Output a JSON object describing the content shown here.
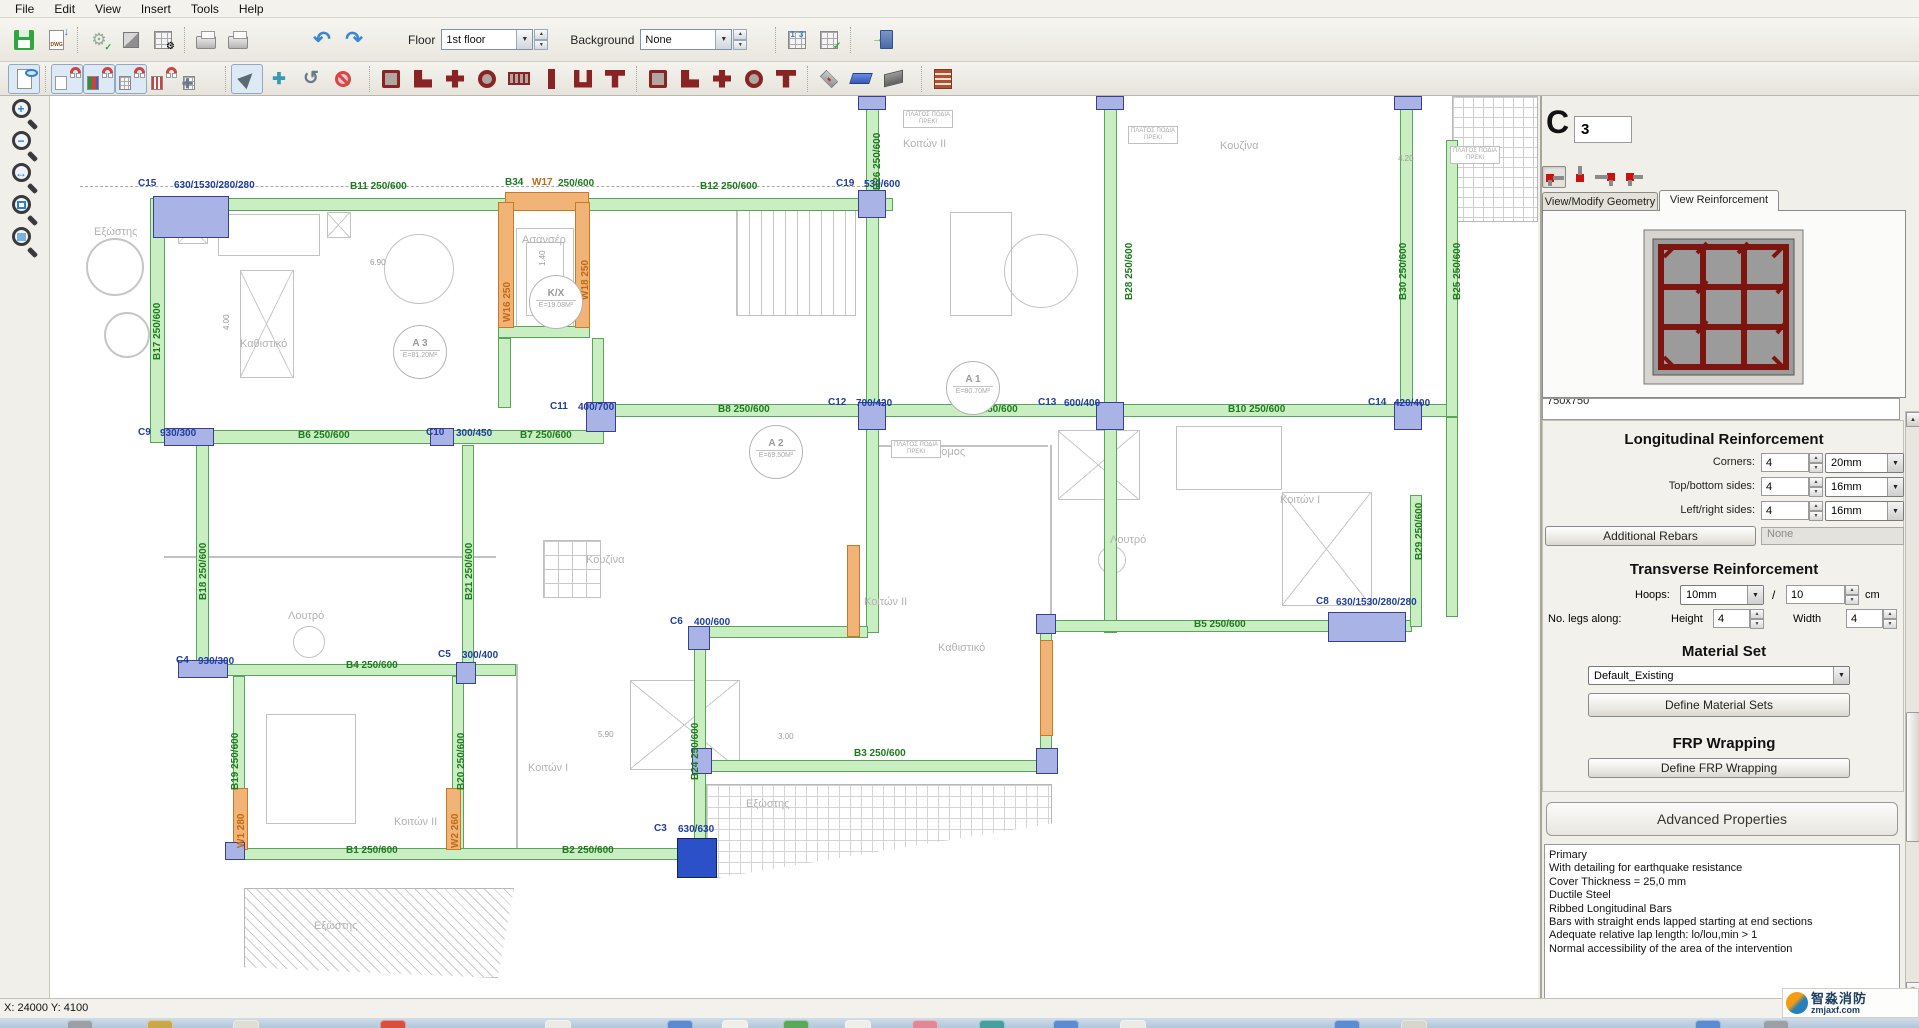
{
  "menu": {
    "items": [
      "File",
      "Edit",
      "View",
      "Insert",
      "Tools",
      "Help"
    ]
  },
  "toolbar": {
    "floor_label": "Floor",
    "floor_value": "1st floor",
    "background_label": "Background",
    "background_value": "None"
  },
  "panel": {
    "member_type": "C",
    "member_number": "3",
    "tabs": [
      {
        "label": "View/Modify Geometry",
        "active": false
      },
      {
        "label": "View Reinforcement",
        "active": true
      }
    ],
    "section_size": "750x750",
    "longitudinal": {
      "title": "Longitudinal Reinforcement",
      "rows": [
        {
          "label": "Corners:",
          "count": "4",
          "diameter": "20mm"
        },
        {
          "label": "Top/bottom sides:",
          "count": "4",
          "diameter": "16mm"
        },
        {
          "label": "Left/right sides:",
          "count": "4",
          "diameter": "16mm"
        }
      ],
      "additional_rebars_button": "Additional Rebars",
      "additional_rebars_value": "None"
    },
    "transverse": {
      "title": "Transverse Reinforcement",
      "hoops_label": "Hoops:",
      "hoops_diameter": "10mm",
      "separator": "/",
      "spacing": "10",
      "spacing_unit": "cm",
      "legs_label": "No. legs along:",
      "height_label": "Height",
      "height_value": "4",
      "width_label": "Width",
      "width_value": "4"
    },
    "material": {
      "title": "Material Set",
      "selected": "Default_Existing",
      "button": "Define Material Sets"
    },
    "frp": {
      "title": "FRP Wrapping",
      "button": "Define FRP Wrapping"
    },
    "advanced": {
      "title": "Advanced Properties",
      "lines": [
        "Primary",
        "With detailing for earthquake resistance",
        "Cover Thickness = 25,0 mm",
        "Ductile Steel",
        "Ribbed Longitudinal Bars",
        "Bars with straight ends lapped starting at end sections",
        "Adequate relative lap length: lo/lou,min > 1",
        "Normal accessibility of the area of the intervention"
      ]
    },
    "colors": {
      "rebar": "#7c150f",
      "concrete": "#9b9b9b",
      "selected_column": "#2b50c8"
    }
  },
  "status_bar": {
    "coords": "X: 24000  Y: 4100"
  },
  "watermark": {
    "line1": "智淼消防",
    "line2": "zmjaxf.com"
  },
  "plan": {
    "box_label": [
      "ΠΛΑΤΟΣ ΠΟΔΙΑ",
      "ΠΡΕΚΙ"
    ],
    "beams": [
      [
        153,
        198,
        740,
        13,
        "g"
      ],
      [
        150,
        198,
        15,
        245,
        "g"
      ],
      [
        164,
        430,
        440,
        14,
        "g"
      ],
      [
        196,
        443,
        13,
        222,
        "g"
      ],
      [
        592,
        404,
        862,
        13,
        "g"
      ],
      [
        866,
        96,
        13,
        315,
        "g"
      ],
      [
        1104,
        96,
        13,
        315,
        "g"
      ],
      [
        1400,
        96,
        13,
        315,
        "g"
      ],
      [
        1446,
        140,
        12,
        277,
        "g"
      ],
      [
        866,
        417,
        13,
        216,
        "g"
      ],
      [
        1104,
        417,
        13,
        216,
        "g"
      ],
      [
        1446,
        417,
        12,
        200,
        "g"
      ],
      [
        700,
        626,
        168,
        12,
        "g"
      ],
      [
        1050,
        620,
        362,
        12,
        "g"
      ],
      [
        1410,
        495,
        12,
        132,
        "g"
      ],
      [
        700,
        760,
        352,
        12,
        "g"
      ],
      [
        694,
        632,
        12,
        216,
        "g"
      ],
      [
        1040,
        632,
        12,
        140,
        "g"
      ],
      [
        196,
        664,
        320,
        12,
        "g"
      ],
      [
        233,
        676,
        12,
        180,
        "g"
      ],
      [
        452,
        676,
        12,
        180,
        "g"
      ],
      [
        462,
        445,
        12,
        225,
        "g"
      ],
      [
        233,
        848,
        477,
        12,
        "g"
      ],
      [
        498,
        326,
        92,
        12,
        "g"
      ],
      [
        498,
        338,
        13,
        70,
        "g"
      ],
      [
        592,
        338,
        12,
        66,
        "g"
      ],
      [
        505,
        192,
        84,
        19,
        "o"
      ],
      [
        498,
        202,
        16,
        126,
        "o"
      ],
      [
        575,
        202,
        15,
        126,
        "o"
      ],
      [
        233,
        788,
        15,
        62,
        "o"
      ],
      [
        446,
        788,
        15,
        62,
        "o"
      ],
      [
        1040,
        640,
        13,
        96,
        "o"
      ],
      [
        847,
        545,
        13,
        92,
        "o"
      ]
    ],
    "columns": [
      [
        153,
        196,
        76,
        42,
        0
      ],
      [
        858,
        190,
        28,
        28,
        0
      ],
      [
        586,
        402,
        30,
        30,
        0
      ],
      [
        858,
        402,
        28,
        28,
        0
      ],
      [
        1096,
        402,
        28,
        28,
        0
      ],
      [
        1394,
        402,
        28,
        28,
        0
      ],
      [
        164,
        428,
        50,
        18,
        0
      ],
      [
        430,
        428,
        24,
        18,
        0
      ],
      [
        178,
        660,
        50,
        18,
        0
      ],
      [
        456,
        662,
        20,
        22,
        0
      ],
      [
        688,
        626,
        22,
        24,
        0
      ],
      [
        1328,
        612,
        78,
        30,
        0
      ],
      [
        692,
        748,
        20,
        26,
        0
      ],
      [
        1036,
        748,
        22,
        26,
        0
      ],
      [
        1036,
        614,
        20,
        20,
        0
      ],
      [
        225,
        842,
        20,
        18,
        0
      ],
      [
        858,
        96,
        28,
        14,
        0
      ],
      [
        1096,
        96,
        28,
        14,
        0
      ],
      [
        1394,
        96,
        28,
        14,
        0
      ],
      [
        677,
        838,
        40,
        40,
        1
      ]
    ],
    "labels": [
      [
        138,
        178,
        "C15",
        "b",
        0
      ],
      [
        174,
        180,
        "630/1530/280/280",
        "b",
        0
      ],
      [
        350,
        181,
        "B11  250/600",
        "g",
        0
      ],
      [
        505,
        177,
        "B34",
        "g",
        0
      ],
      [
        532,
        177,
        "W17",
        "o",
        0
      ],
      [
        558,
        178,
        "250/600",
        "g",
        0
      ],
      [
        700,
        181,
        "B12  250/600",
        "g",
        0
      ],
      [
        836,
        178,
        "C19",
        "b",
        0
      ],
      [
        864,
        179,
        "530/600",
        "b",
        0
      ],
      [
        872,
        190,
        "B26  250/600",
        "g",
        1
      ],
      [
        1124,
        300,
        "B28  250/600",
        "g",
        1
      ],
      [
        1398,
        300,
        "B30  250/600",
        "g",
        1
      ],
      [
        1452,
        300,
        "B25  250/600",
        "g",
        1
      ],
      [
        138,
        427,
        "C9",
        "b",
        0
      ],
      [
        160,
        428,
        "930/300",
        "b",
        0
      ],
      [
        298,
        430,
        "B6  250/600",
        "g",
        0
      ],
      [
        426,
        427,
        "C10",
        "b",
        0
      ],
      [
        456,
        428,
        "300/450",
        "b",
        0
      ],
      [
        520,
        430,
        "B7  250/600",
        "g",
        0
      ],
      [
        550,
        401,
        "C11",
        "b",
        0
      ],
      [
        578,
        402,
        "400/700",
        "b",
        0
      ],
      [
        718,
        404,
        "B8  250/600",
        "g",
        0
      ],
      [
        828,
        397,
        "C12",
        "b",
        0
      ],
      [
        856,
        398,
        "700/420",
        "b",
        0
      ],
      [
        966,
        404,
        "B9  250/600",
        "g",
        0
      ],
      [
        1038,
        397,
        "C13",
        "b",
        0
      ],
      [
        1064,
        398,
        "600/400",
        "b",
        0
      ],
      [
        1228,
        404,
        "B10  250/600",
        "g",
        0
      ],
      [
        1368,
        397,
        "C14",
        "b",
        0
      ],
      [
        1394,
        398,
        "420/400",
        "b",
        0
      ],
      [
        152,
        360,
        "B17  250/600",
        "g",
        1
      ],
      [
        198,
        600,
        "B18  250/600",
        "g",
        1
      ],
      [
        464,
        600,
        "B21  250/600",
        "g",
        1
      ],
      [
        1414,
        560,
        "B29  250/600",
        "g",
        1
      ],
      [
        1316,
        596,
        "C8",
        "b",
        0
      ],
      [
        1336,
        597,
        "630/1530/280/280",
        "b",
        0
      ],
      [
        1194,
        619,
        "B5  250/600",
        "g",
        0
      ],
      [
        670,
        616,
        "C6",
        "b",
        0
      ],
      [
        694,
        617,
        "400/600",
        "b",
        0
      ],
      [
        176,
        655,
        "C4",
        "b",
        0
      ],
      [
        198,
        656,
        "930/300",
        "b",
        0
      ],
      [
        346,
        660,
        "B4  250/600",
        "g",
        0
      ],
      [
        438,
        649,
        "C5",
        "b",
        0
      ],
      [
        462,
        650,
        "300/400",
        "b",
        0
      ],
      [
        230,
        790,
        "B19  250/600",
        "g",
        1
      ],
      [
        456,
        790,
        "B20  250/600",
        "g",
        1
      ],
      [
        690,
        780,
        "B24  250/600",
        "g",
        1
      ],
      [
        236,
        848,
        "W1  280",
        "o",
        1
      ],
      [
        450,
        848,
        "W2  260",
        "o",
        1
      ],
      [
        346,
        845,
        "B1  250/600",
        "g",
        0
      ],
      [
        562,
        845,
        "B2  250/600",
        "g",
        0
      ],
      [
        654,
        823,
        "C3",
        "b",
        0
      ],
      [
        678,
        824,
        "630/630",
        "b",
        0
      ],
      [
        854,
        748,
        "B3  250/600",
        "g",
        0
      ],
      [
        502,
        322,
        "W16  250",
        "o",
        1
      ],
      [
        580,
        300,
        "W18  250",
        "o",
        1
      ]
    ],
    "rooms": [
      [
        240,
        338,
        "Καθιστικό"
      ],
      [
        903,
        138,
        "Κοιτών II"
      ],
      [
        1220,
        140,
        "Κουζίνα"
      ],
      [
        522,
        234,
        "Ασανσέρ"
      ],
      [
        586,
        554,
        "Κουζίνα"
      ],
      [
        288,
        610,
        "Λουτρό"
      ],
      [
        528,
        762,
        "Κοιτών I"
      ],
      [
        394,
        816,
        "Κοιτών II"
      ],
      [
        864,
        596,
        "Κοιτών II"
      ],
      [
        1280,
        494,
        "Κοιτών I"
      ],
      [
        1110,
        534,
        "Λουτρό"
      ],
      [
        938,
        642,
        "Καθιστικό"
      ],
      [
        314,
        920,
        "Εξώστης"
      ],
      [
        746,
        798,
        "Εξώστης"
      ],
      [
        94,
        226,
        "Εξώστης"
      ],
      [
        914,
        446,
        "διάδρομος"
      ]
    ],
    "dims": [
      [
        370,
        258,
        "6.90",
        0
      ],
      [
        222,
        330,
        "4.00",
        1
      ],
      [
        598,
        730,
        "5.90",
        0
      ],
      [
        778,
        732,
        "3.00",
        0
      ],
      [
        538,
        266,
        "1.40",
        1
      ],
      [
        1398,
        154,
        "4.20",
        0
      ]
    ],
    "area_circles": [
      [
        420,
        352,
        "A 3",
        "E=81.20M²"
      ],
      [
        556,
        302,
        "K/X",
        "E=19.08M²"
      ],
      [
        776,
        452,
        "A 2",
        "E=69.50M²"
      ],
      [
        973,
        388,
        "A 1",
        "E=80.70M²"
      ]
    ],
    "boxes": [
      [
        903,
        110
      ],
      [
        1128,
        126
      ],
      [
        1450,
        146
      ],
      [
        891,
        440
      ]
    ],
    "furniture": [
      [
        218,
        214,
        102,
        42,
        "r"
      ],
      [
        178,
        214,
        30,
        30,
        "x"
      ],
      [
        327,
        212,
        24,
        26,
        "x"
      ],
      [
        240,
        270,
        54,
        108,
        "x"
      ],
      [
        384,
        234,
        70,
        70,
        "c"
      ],
      [
        1004,
        234,
        74,
        74,
        "c"
      ],
      [
        736,
        206,
        120,
        110,
        "st"
      ],
      [
        1282,
        492,
        90,
        114,
        "x"
      ],
      [
        630,
        680,
        110,
        90,
        "x"
      ],
      [
        266,
        714,
        90,
        110,
        "r"
      ],
      [
        543,
        540,
        58,
        58,
        "g2"
      ],
      [
        293,
        626,
        32,
        32,
        "c"
      ],
      [
        1098,
        546,
        28,
        28,
        "c"
      ],
      [
        1176,
        426,
        106,
        64,
        "r"
      ],
      [
        950,
        212,
        62,
        104,
        "r"
      ],
      [
        1058,
        430,
        82,
        70,
        "x"
      ],
      [
        516,
        228,
        58,
        102,
        "r"
      ],
      [
        526,
        242,
        38,
        74,
        "r"
      ],
      [
        164,
        556,
        332,
        2,
        "r"
      ],
      [
        1050,
        445,
        2,
        176,
        "r"
      ],
      [
        516,
        664,
        2,
        184,
        "r"
      ],
      [
        868,
        445,
        180,
        2,
        "r"
      ],
      [
        80,
        186,
        800,
        1,
        "dash"
      ],
      [
        244,
        888,
        270,
        90,
        "h45"
      ],
      [
        706,
        784,
        346,
        94,
        "tg"
      ],
      [
        1452,
        96,
        86,
        126,
        "gr"
      ],
      [
        86,
        238,
        58,
        58,
        "gc"
      ],
      [
        104,
        312,
        46,
        46,
        "gc"
      ]
    ]
  },
  "taskbar": {
    "icons": [
      [
        67,
        "#9aa0a6"
      ],
      [
        147,
        "#caa84a"
      ],
      [
        233,
        "#e0ddd4"
      ],
      [
        380,
        "#d94f3f"
      ],
      [
        545,
        "#eceae4"
      ],
      [
        667,
        "#5b8bd0"
      ],
      [
        722,
        "#f0eee8"
      ],
      [
        783,
        "#5aa85a"
      ],
      [
        845,
        "#f0eee8"
      ],
      [
        912,
        "#e08898"
      ],
      [
        979,
        "#46a0a0"
      ],
      [
        1053,
        "#5b8bd0"
      ],
      [
        1120,
        "#eceae4"
      ],
      [
        1334,
        "#5b8bd0"
      ],
      [
        1401,
        "#d8d5cc"
      ],
      [
        1695,
        "#5b8bd0"
      ],
      [
        1763,
        "#9aa0a6"
      ]
    ]
  }
}
